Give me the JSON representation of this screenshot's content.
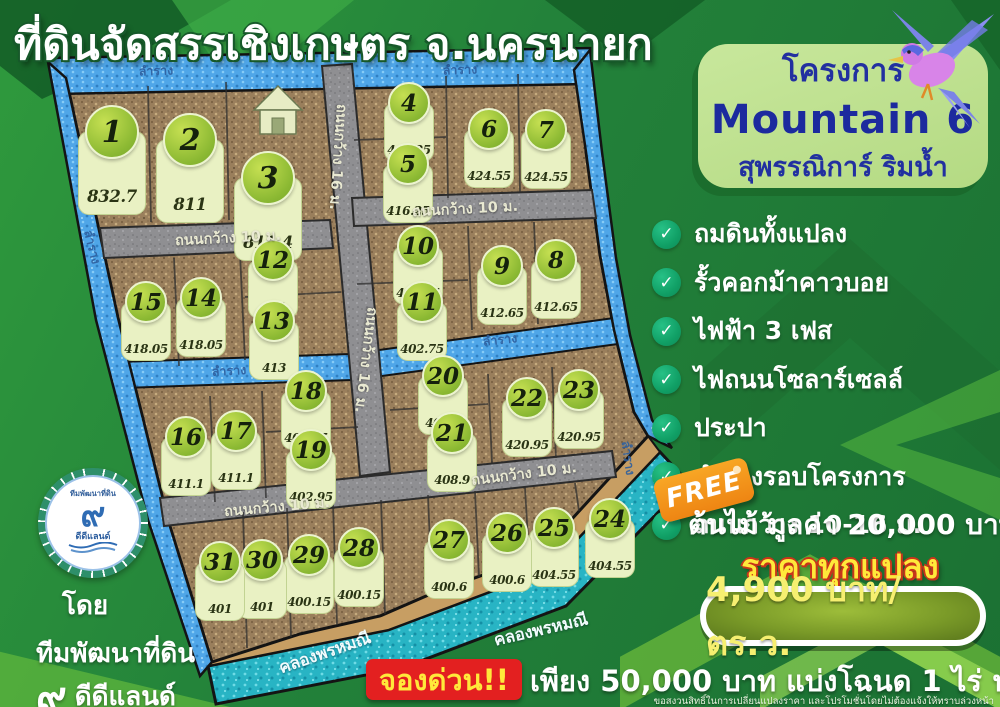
{
  "title": "ที่ดินจัดสรรเชิงเกษตร จ.นครนายก",
  "project_card": {
    "prefix": "โครงการ",
    "name": "Mountain 6",
    "subtitle": "สุพรรณิการ์ ริมน้ำ"
  },
  "features": [
    "ถมดินทั้งแปลง",
    "รั้วคอกม้าคาวบอย",
    "ไฟฟ้า 3 เฟส",
    "ไฟถนนโซลาร์เซลล์",
    "ประปา",
    "ลำรางรอบโครงการ",
    "ถนนกว้าง 10-16 ม."
  ],
  "check_glyph": "✓",
  "promo": {
    "free_label": "FREE",
    "free_text": "ต้นไม้ มูลค่า 20,000 บาท",
    "price_heading": "ราคาทุกแปลง",
    "price_value": "4,900 บาท/ตร.ว."
  },
  "booking": {
    "badge": "จองด่วน!!",
    "text": "เพียง 50,000 บาท แบ่งโฉนด 1 ไร่ ฟรี!!!",
    "disclaimer": "ขอสงวนสิทธิ์ในการเปลี่ยนแปลงราคา และโปรโมชั่นโดยไม่ต้องแจ้งให้ทราบล่วงหน้า"
  },
  "developer": {
    "by": "โดย",
    "team": "ทีมพัฒนาที่ดิน",
    "numeral": "๙",
    "brand": "ดีดีแลนด์"
  },
  "logo": {
    "arc_text": "ทีมพัฒนาที่ดิน",
    "numeral": "๙",
    "brand": "ดีดีแลนด์"
  },
  "map": {
    "road_label_10": "ถนนกว้าง 10 ม.",
    "road_label_16": "ถนนกว้าง 16 ม.",
    "canal_label": "ลำราง",
    "main_canal_label": "คลองพรหมณี",
    "plots": [
      {
        "no": "1",
        "area": "832.7"
      },
      {
        "no": "2",
        "area": "811"
      },
      {
        "no": "3",
        "area": "811.4"
      },
      {
        "no": "4",
        "area": "416.25"
      },
      {
        "no": "5",
        "area": "416.25"
      },
      {
        "no": "6",
        "area": "424.55"
      },
      {
        "no": "7",
        "area": "424.55"
      },
      {
        "no": "8",
        "area": "412.65"
      },
      {
        "no": "9",
        "area": "412.65"
      },
      {
        "no": "10",
        "area": "402.75"
      },
      {
        "no": "11",
        "area": "402.75"
      },
      {
        "no": "12",
        "area": "413"
      },
      {
        "no": "13",
        "area": "413"
      },
      {
        "no": "14",
        "area": "418.05"
      },
      {
        "no": "15",
        "area": "418.05"
      },
      {
        "no": "16",
        "area": "411.1"
      },
      {
        "no": "17",
        "area": "411.1"
      },
      {
        "no": "18",
        "area": "402.95"
      },
      {
        "no": "19",
        "area": "402.95"
      },
      {
        "no": "20",
        "area": "408.9"
      },
      {
        "no": "21",
        "area": "408.9"
      },
      {
        "no": "22",
        "area": "420.95"
      },
      {
        "no": "23",
        "area": "420.95"
      },
      {
        "no": "24",
        "area": "404.55"
      },
      {
        "no": "25",
        "area": "404.55"
      },
      {
        "no": "26",
        "area": "400.6"
      },
      {
        "no": "27",
        "area": "400.6"
      },
      {
        "no": "28",
        "area": "400.15"
      },
      {
        "no": "29",
        "area": "400.15"
      },
      {
        "no": "30",
        "area": "401"
      },
      {
        "no": "31",
        "area": "401"
      }
    ]
  },
  "colors": {
    "background_green": "#23823a",
    "card_green": "#bfe196",
    "navy": "#222f9e",
    "check_teal": "#11a066",
    "price_yellow": "#ffe93a",
    "tag_orange": "#f59a1f",
    "badge_red": "#e32020",
    "canal_blue": "#4fa6e8",
    "main_canal_teal": "#28b4c4",
    "plot_brown": "#9a7f5c",
    "road_gray": "#909093"
  }
}
